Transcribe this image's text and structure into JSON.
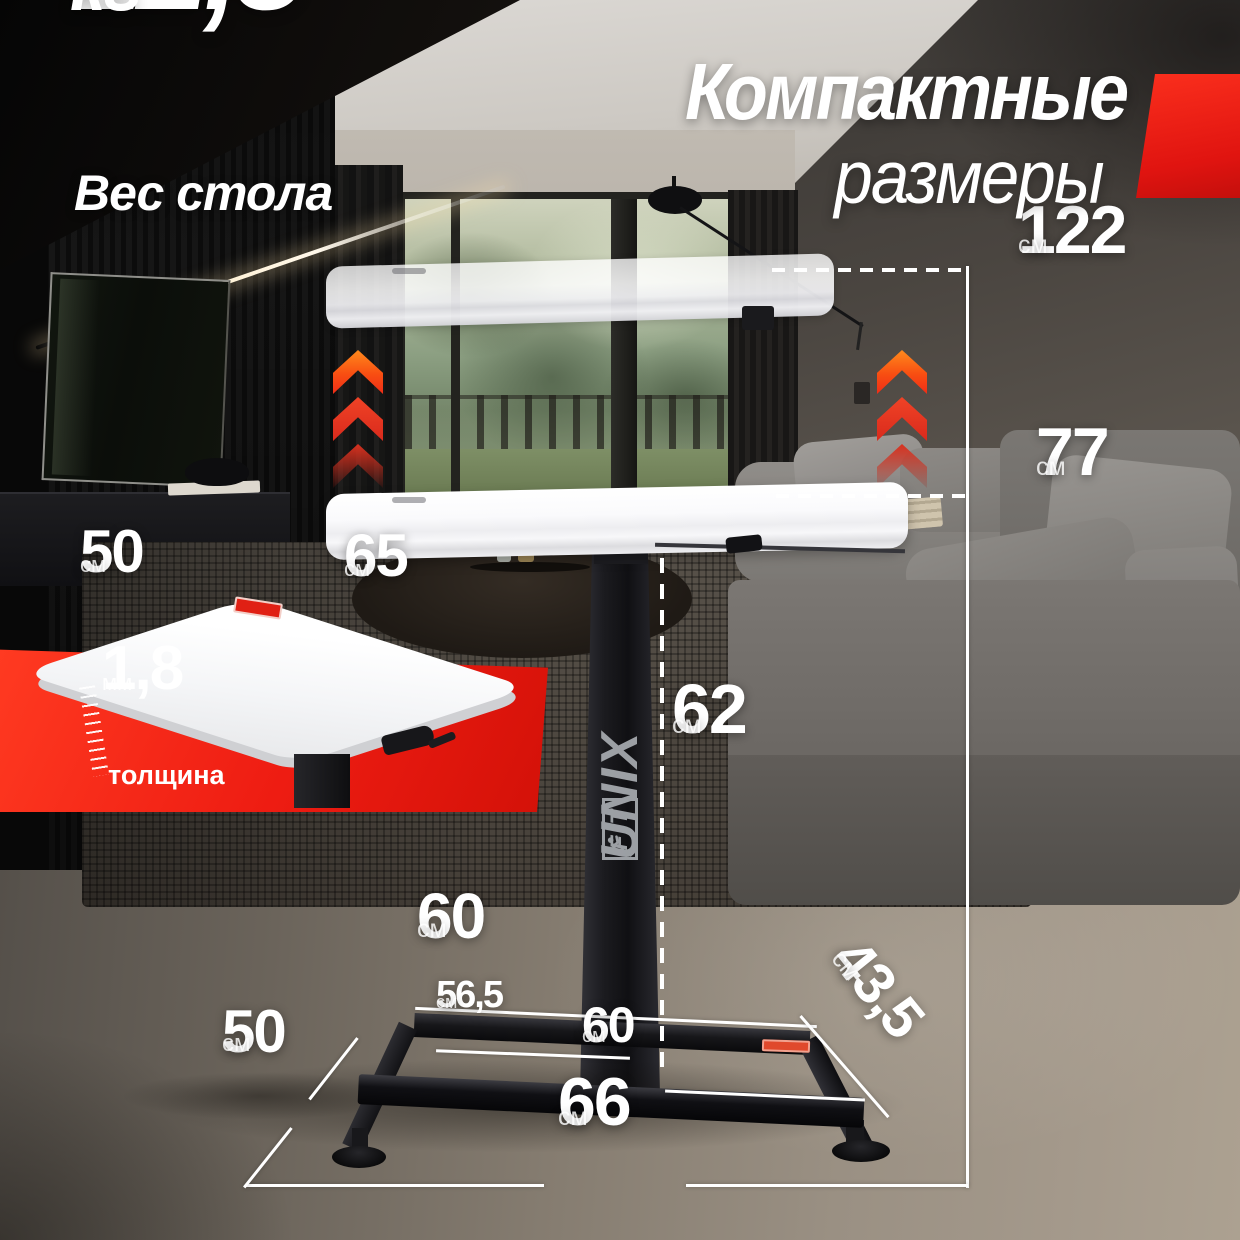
{
  "header": {
    "weight": {
      "value": "12,8",
      "unit": "кг",
      "caption": "Вес стола"
    },
    "title": {
      "line1": "Компактные",
      "line2": "размеры"
    }
  },
  "brand": {
    "name": "UNIX",
    "suffix": "FIT"
  },
  "measurements": {
    "max_height": {
      "value": "122",
      "unit": "см"
    },
    "min_height": {
      "value": "77",
      "unit": "см"
    },
    "frame_height": {
      "value": "62",
      "unit": "см"
    },
    "tabletop_depth": {
      "value": "50",
      "unit": "см"
    },
    "tabletop_width": {
      "value": "65",
      "unit": "см"
    },
    "tabletop_thickness": {
      "value": "1,8",
      "unit": "мм",
      "caption": "толщина"
    },
    "base_back_width": {
      "value": "60",
      "unit": "см"
    },
    "base_inner_width": {
      "value": "56,5",
      "unit": "см"
    },
    "base_front_width": {
      "value": "60",
      "unit": "см"
    },
    "base_leg_length": {
      "value": "43,5",
      "unit": "см"
    },
    "base_depth": {
      "value": "50",
      "unit": "см"
    },
    "base_outer_width": {
      "value": "66",
      "unit": "см"
    }
  },
  "colors": {
    "accent_red": "#e8231a",
    "accent_orange": "#ff7a1c",
    "text": "#ffffff"
  }
}
